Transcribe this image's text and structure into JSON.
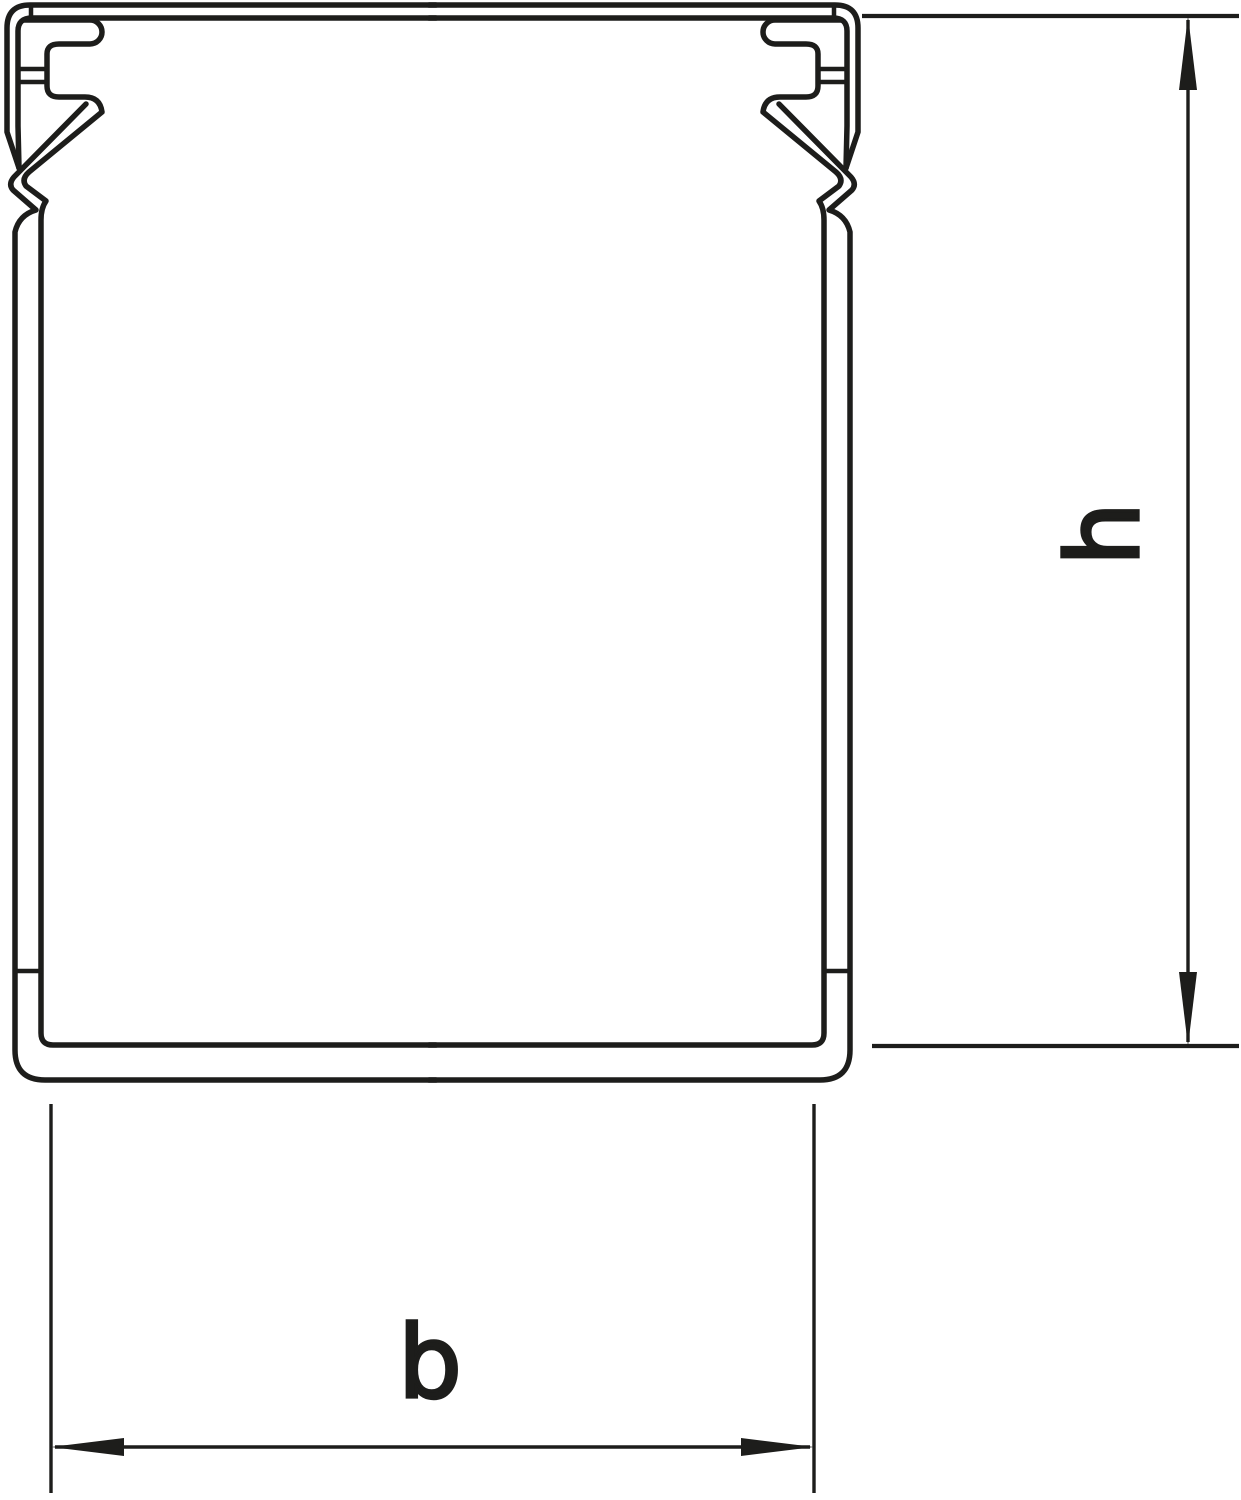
{
  "page": {
    "background_color": "#ffffff"
  },
  "drawing": {
    "kind": "technical-cross-section",
    "subject": "cable trunking (wiring duct) profile with snap-on cover",
    "line_color": "#1d1d1b",
    "dimension_labels": {
      "height": "h",
      "width": "b"
    }
  }
}
